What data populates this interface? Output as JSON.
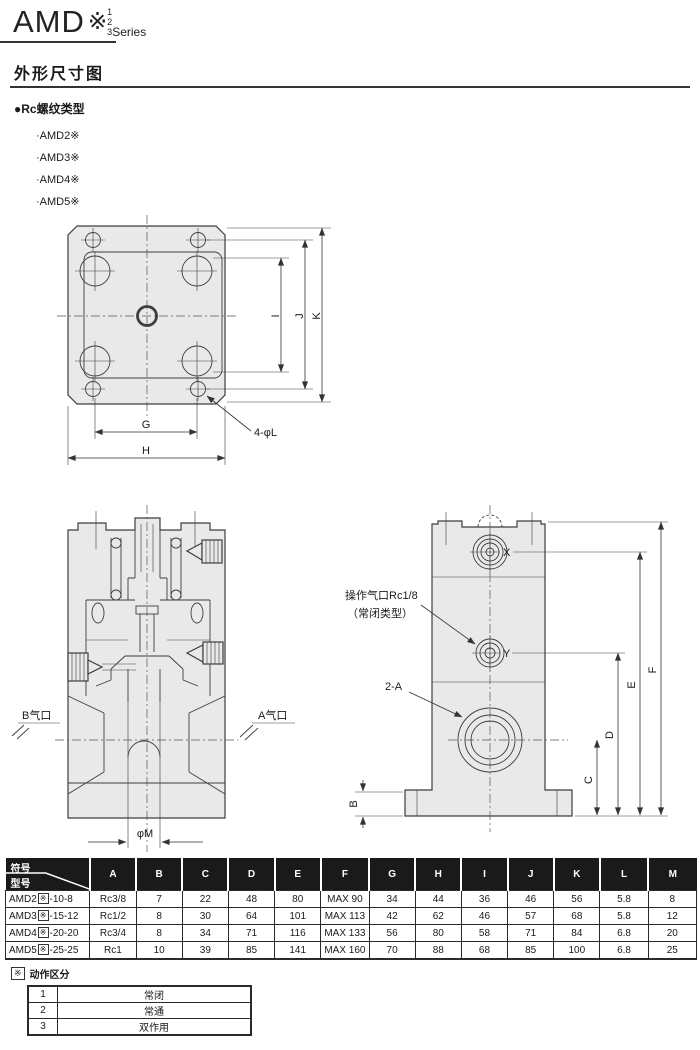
{
  "header": {
    "logo_text": "AMD",
    "logo_mark": "※",
    "logo_nums": [
      "1",
      "2",
      "3"
    ],
    "logo_series": "Series"
  },
  "section": {
    "title": "外形尺寸图",
    "subtitle": "●Rc螺纹类型",
    "models": [
      "·AMD2※",
      "·AMD3※",
      "·AMD4※",
      "·AMD5※"
    ]
  },
  "drawing": {
    "top_view": {
      "dim_g": "G",
      "dim_h": "H",
      "dim_i": "I",
      "dim_j": "J",
      "dim_k": "K",
      "holes_label": "4-φL"
    },
    "section_view": {
      "port_b": "B气口",
      "port_a": "A气口",
      "dim_m": "φM"
    },
    "side_view": {
      "port_x": "X",
      "port_y": "Y",
      "pilot_label": "操作气口Rc1/8",
      "pilot_note": "（常闭类型）",
      "ports_label": "2-A",
      "dim_b": "B",
      "dim_c": "C",
      "dim_d": "D",
      "dim_e": "E",
      "dim_f": "F"
    }
  },
  "table": {
    "corner_top": "符号",
    "corner_bottom": "型号",
    "columns": [
      "A",
      "B",
      "C",
      "D",
      "E",
      "F",
      "G",
      "H",
      "I",
      "J",
      "K",
      "L",
      "M"
    ],
    "rows": [
      {
        "model_prefix": "AMD2",
        "model_mark": "※",
        "model_suffix": "-10-8",
        "values": [
          "Rc3/8",
          "7",
          "22",
          "48",
          "80",
          "MAX 90",
          "34",
          "44",
          "36",
          "46",
          "56",
          "5.8",
          "8"
        ]
      },
      {
        "model_prefix": "AMD3",
        "model_mark": "※",
        "model_suffix": "-15-12",
        "values": [
          "Rc1/2",
          "8",
          "30",
          "64",
          "101",
          "MAX 113",
          "42",
          "62",
          "46",
          "57",
          "68",
          "5.8",
          "12"
        ]
      },
      {
        "model_prefix": "AMD4",
        "model_mark": "※",
        "model_suffix": "-20-20",
        "values": [
          "Rc3/4",
          "8",
          "34",
          "71",
          "116",
          "MAX 133",
          "56",
          "80",
          "58",
          "71",
          "84",
          "6.8",
          "20"
        ]
      },
      {
        "model_prefix": "AMD5",
        "model_mark": "※",
        "model_suffix": "-25-25",
        "values": [
          "Rc1",
          "10",
          "39",
          "85",
          "141",
          "MAX 160",
          "70",
          "88",
          "68",
          "85",
          "100",
          "6.8",
          "25"
        ]
      }
    ]
  },
  "action_table": {
    "mark": "※",
    "title": "动作区分",
    "rows": [
      {
        "num": "1",
        "label": "常闭"
      },
      {
        "num": "2",
        "label": "常通"
      },
      {
        "num": "3",
        "label": "双作用"
      }
    ]
  },
  "colors": {
    "header_bg": "#1a1a1a",
    "header_fg": "#ffffff",
    "line": "#3d3d3d",
    "drawing_fill": "#e9e9e9"
  }
}
